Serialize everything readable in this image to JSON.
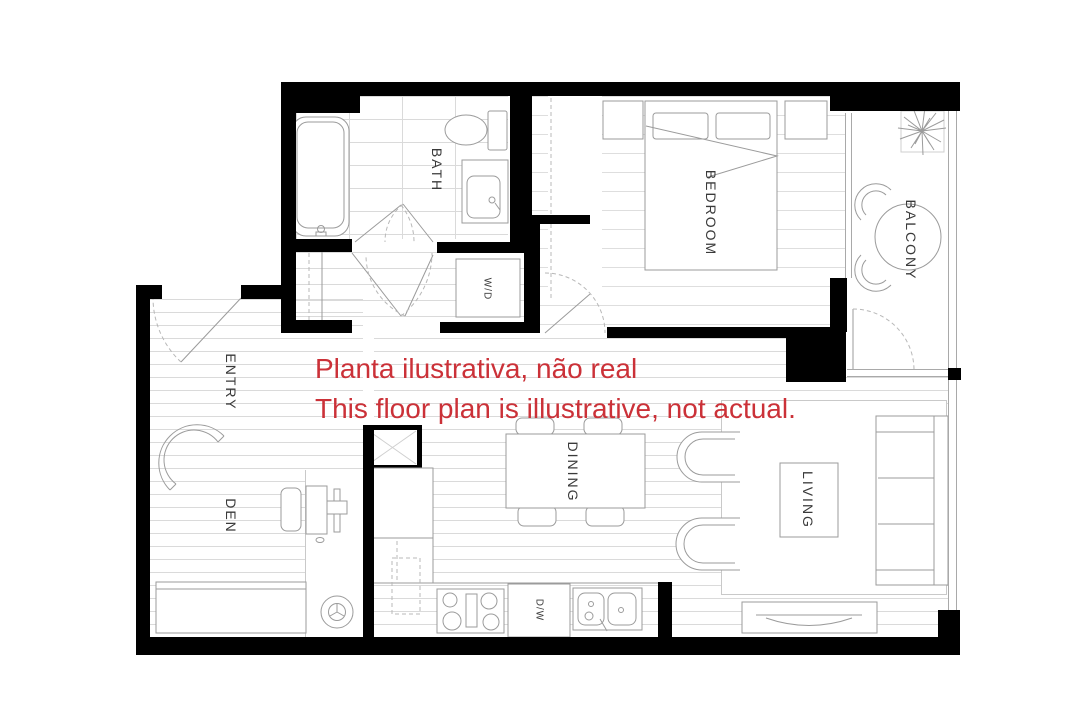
{
  "plan": {
    "disclaimer": {
      "line1": "Planta ilustrativa, não real",
      "line2": "This floor plan is illustrative, not actual."
    },
    "rooms": {
      "bath": "BATH",
      "bedroom": "BEDROOM",
      "balcony": "BALCONY",
      "entry": "ENTRY",
      "den": "DEN",
      "dining": "DINING",
      "living": "LIVING"
    },
    "appliances": {
      "washer_dryer": "W/D",
      "dishwasher": "D/W"
    },
    "colors": {
      "wall": "#000000",
      "floor_line": "#dadada",
      "furniture_line": "#9b9b9b",
      "label_text": "#3a3a3a",
      "disclaimer_red": "#cb3138",
      "background": "#ffffff"
    }
  }
}
